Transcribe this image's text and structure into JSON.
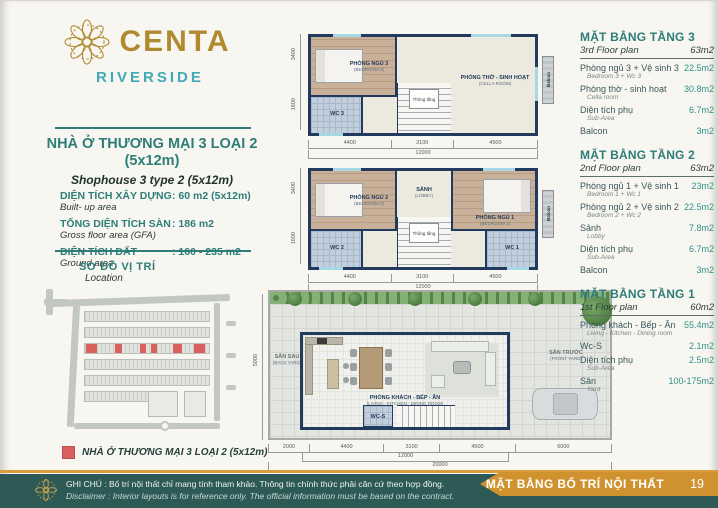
{
  "colors": {
    "brand_gold": "#b08a2e",
    "brand_teal": "#41a9b4",
    "heading_teal": "#2e7d78",
    "value_teal": "#2e9186",
    "wall_navy": "#223a5e",
    "highlight_red": "#d9605c",
    "footer_teal": "#2d5a57",
    "ribbon_gold": "#d0922f"
  },
  "logo": {
    "brand": "CENTA",
    "sub": "RIVERSIDE"
  },
  "info": {
    "title1": "NHÀ Ở THƯƠNG MẠI 3 LOẠI 2",
    "title2": "(5x12m)",
    "subtitle": "Shophouse 3 type 2 (5x12m)",
    "specs": [
      {
        "label": "DIỆN TÍCH XÂY DỰNG",
        "value": ": 60 m2 (5x12m)",
        "sub": "Built- up area"
      },
      {
        "label": "TỔNG DIỆN TÍCH SÀN",
        "value": ": 186 m2",
        "sub": "Gross floor area (GFA)"
      },
      {
        "label": "DIỆN TÍCH ĐẤT",
        "value": ": 160 - 235 m2",
        "sub": "Ground area"
      }
    ]
  },
  "location": {
    "title": "SƠ ĐỒ VỊ TRÍ",
    "sub": "Location",
    "legend": "NHÀ Ở THƯƠNG MẠI 3 LOẠI 2 (5x12m)"
  },
  "plans": {
    "floor3": {
      "rooms": {
        "bedroom": "PHÒNG NGỦ 3",
        "bedroom_sub": "(BEDROOM 3)",
        "wc": "WC 3",
        "cella": "PHÒNG THỜ - SINH HOẠT",
        "cella_sub": "(CELLA ROOM)",
        "void": "Thông tầng",
        "balcony": "Balcon"
      },
      "dims": {
        "w1": "4400",
        "w2": "3100",
        "w3": "4500",
        "total": "12000",
        "d1": "3400",
        "d2": "1600"
      }
    },
    "floor2": {
      "rooms": {
        "bedroom2": "PHÒNG NGỦ 2",
        "bedroom2_sub": "(BEDROOM 2)",
        "wc2": "WC 2",
        "lobby": "SẢNH",
        "lobby_sub": "(LOBBY)",
        "void": "Thông tầng",
        "bedroom1": "PHÒNG NGỦ 1",
        "bedroom1_sub": "(BEDROOM 1)",
        "wc1": "WC 1",
        "balcony": "Balcon"
      },
      "dims": {
        "w1": "4400",
        "w2": "3100",
        "w3": "4500",
        "total": "12000",
        "d1": "3400",
        "d2": "1600"
      }
    },
    "floor1": {
      "rooms": {
        "backyard": "SÂN SAU",
        "backyard_sub": "(BACK YARD)",
        "living": "PHÒNG KHÁCH - BẾP - ĂN",
        "living_sub": "(LIVING - KITCHEN - DINING ROOM)",
        "wc": "WC-S",
        "frontyard": "SÂN TRƯỚC",
        "frontyard_sub": "(FRONT YARD)"
      },
      "dims": {
        "left": "2000",
        "w1": "4400",
        "w2": "3100",
        "w3": "4500",
        "right": "6000",
        "mid_total": "12000",
        "total": "20000",
        "depth": "5000"
      }
    }
  },
  "floor_tables": [
    {
      "title": "MẶT BẰNG TẦNG 3",
      "subtitle": "3rd Floor plan",
      "total": "63m2",
      "rows": [
        {
          "label": "Phòng ngủ 3 + Vệ sinh 3",
          "sub": "Bedroom 3 + Wc 3",
          "value": "22.5m2"
        },
        {
          "label": "Phòng thờ - sinh hoạt",
          "sub": "Cella room",
          "value": "30.8m2"
        },
        {
          "label": "Diện tích phụ",
          "sub": "Sub-Area",
          "value": "6.7m2"
        },
        {
          "label": "Balcon",
          "sub": "",
          "value": "3m2"
        }
      ]
    },
    {
      "title": "MẶT BẰNG TẦNG 2",
      "subtitle": "2nd Floor plan",
      "total": "63m2",
      "rows": [
        {
          "label": "Phòng ngủ 1 + Vệ sinh 1",
          "sub": "Bedroom 1 + Wc 1",
          "value": "23m2"
        },
        {
          "label": "Phòng ngủ 2 + Vệ sinh 2",
          "sub": "Bedroom 2 + Wc 2",
          "value": "22.5m2"
        },
        {
          "label": "Sảnh",
          "sub": "Lobby",
          "value": "7.8m2"
        },
        {
          "label": "Diện tích phụ",
          "sub": "Sub-Area",
          "value": "6.7m2"
        },
        {
          "label": "Balcon",
          "sub": "",
          "value": "3m2"
        }
      ]
    },
    {
      "title": "MẶT BẰNG TẦNG 1",
      "subtitle": "1st Floor plan",
      "total": "60m2",
      "rows": [
        {
          "label": "Phòng khách - Bếp - Ăn",
          "sub": "Living - Kitchen - Dining room",
          "value": "55.4m2"
        },
        {
          "label": "Wc-S",
          "sub": "",
          "value": "2.1m2"
        },
        {
          "label": "Diện tích phụ",
          "sub": "Sub-Area",
          "value": "2.5m2"
        },
        {
          "label": "Sân",
          "sub": "Yard",
          "value": "100-175m2"
        }
      ]
    }
  ],
  "footer": {
    "note_vi": "GHI CHÚ : Bố trí nội thất chỉ mang tính tham khảo. Thông tin chính thức phải căn cứ theo hợp đồng.",
    "note_en": "Disclaimer : Interior layouts is for reference only. The official information must be based on the contract.",
    "ribbon": "MẶT BẰNG BỐ TRÍ NỘI THẤT",
    "page": "19"
  }
}
